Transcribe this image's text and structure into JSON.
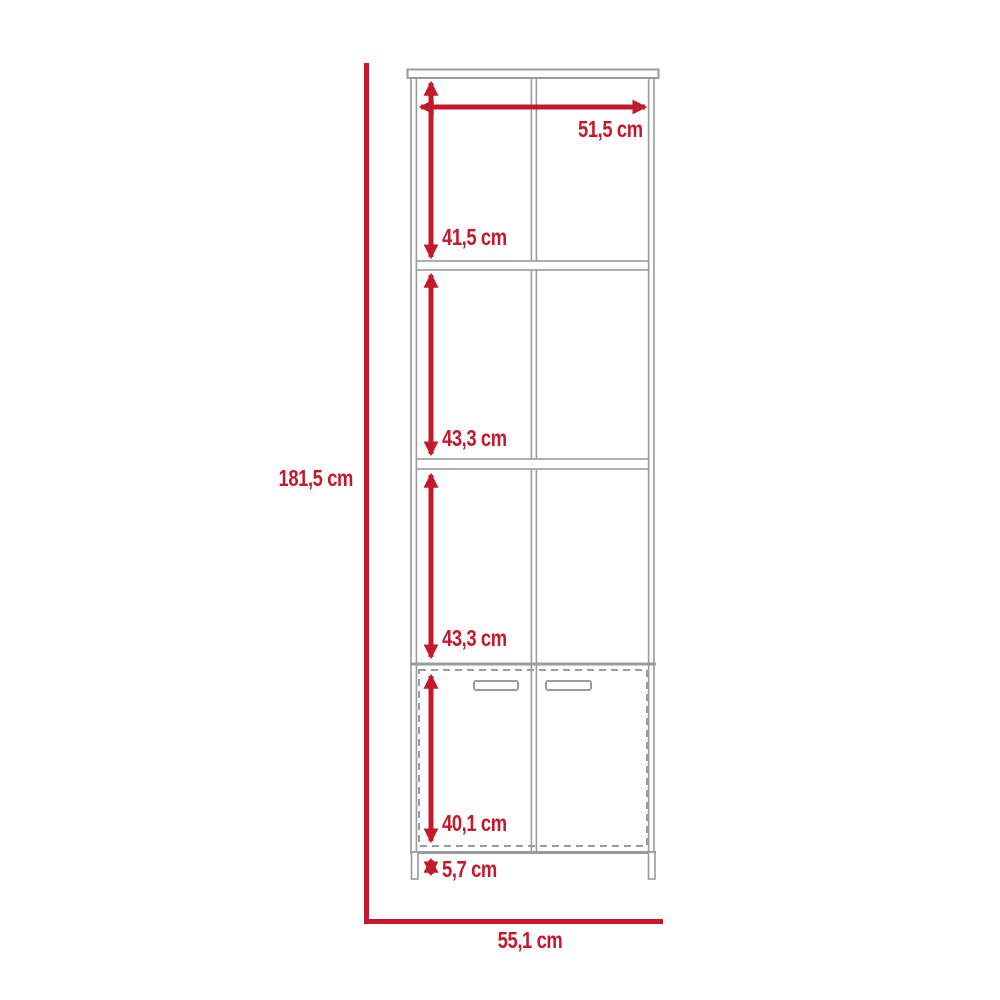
{
  "diagram": {
    "colors": {
      "dimension_red": "#C4192C",
      "outline_gray": "#9B9B9B",
      "background": "#FFFFFF"
    },
    "dimensions": {
      "overall_height": "181,5 cm",
      "interior_width": "51,5 cm",
      "compartment_top": "41,5 cm",
      "compartment_middle": "43,3 cm",
      "compartment_lower": "43,3 cm",
      "door_section": "40,1 cm",
      "legs": "5,7 cm",
      "overall_width": "55,1 cm"
    }
  }
}
